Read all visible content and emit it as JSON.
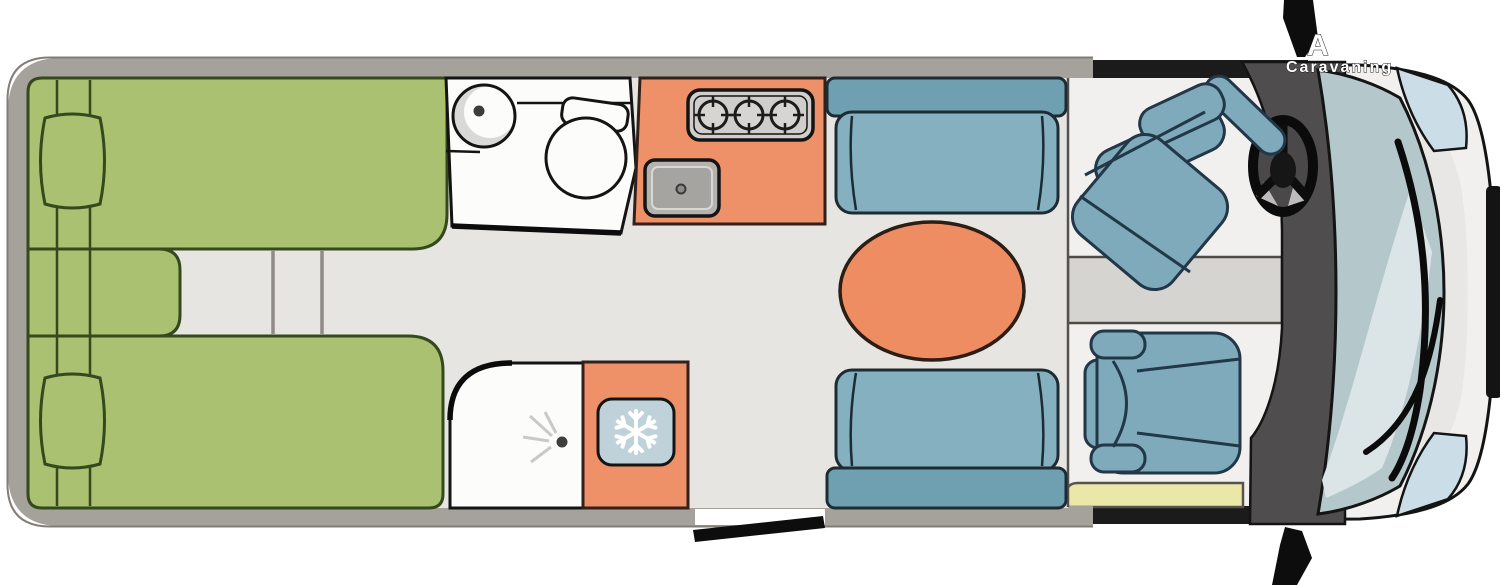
{
  "title": "Campervan floor plan (top view)",
  "watermark": {
    "line1": "A",
    "line2": "Caravaning"
  },
  "fixtures": {
    "beds": 2,
    "pillows": 2,
    "hob_burners": 3,
    "sofas": 2,
    "cab_seats": 2,
    "dinette_tables": 1
  },
  "icons": {
    "fridge_icon": "snowflake",
    "shower_icon": "spray-nozzle",
    "hob_icon": "burner-rings",
    "steering_wheel_icon": "steering-wheel",
    "toilet_icon": "toilet-top-view",
    "washbasin_icon": "round-basin"
  },
  "colors": {
    "background": "#ffffff",
    "wall": "#a5a19b",
    "wall_edge": "#827e77",
    "floor": "#e7e5e2",
    "cab_floor": "#f1f0ee",
    "bed_green": "#a9c171",
    "bed_outline": "#34491c",
    "kitchen_orange": "#ee9068",
    "orange_outline": "#31211a",
    "table_orange": "#ee8c62",
    "sofa_back_blue": "#6fa0b2",
    "sofa_seat_blue": "#85b0bf",
    "sofa_outline": "#1d2b33",
    "seat_blue": "#7eaabb",
    "seat_outline": "#223747",
    "stove_gray": "#cfcecb",
    "burner_gray": "#d6d5d2",
    "sink_gray": "#b3b2af",
    "basin_gray": "#a5a4a1",
    "white_fixture": "#fcfcfb",
    "shade_gray": "#d9d9d7",
    "ray_gray": "#c9c9c7",
    "fridge_blue": "#bfd2da",
    "step_yellow": "#ebe7a9",
    "console_gray": "#d6d4d1",
    "dashboard_gray": "#4f4d4e",
    "trim_black": "#141414",
    "windshield_blue": "#b4c7cb",
    "windshield_highlight": "#dbe5e7",
    "hood_shade": "#e8e7e5",
    "headlight_blue": "#cbdde6",
    "line_dark": "#1b1b1b",
    "snowflake_white": "#ffffff"
  }
}
